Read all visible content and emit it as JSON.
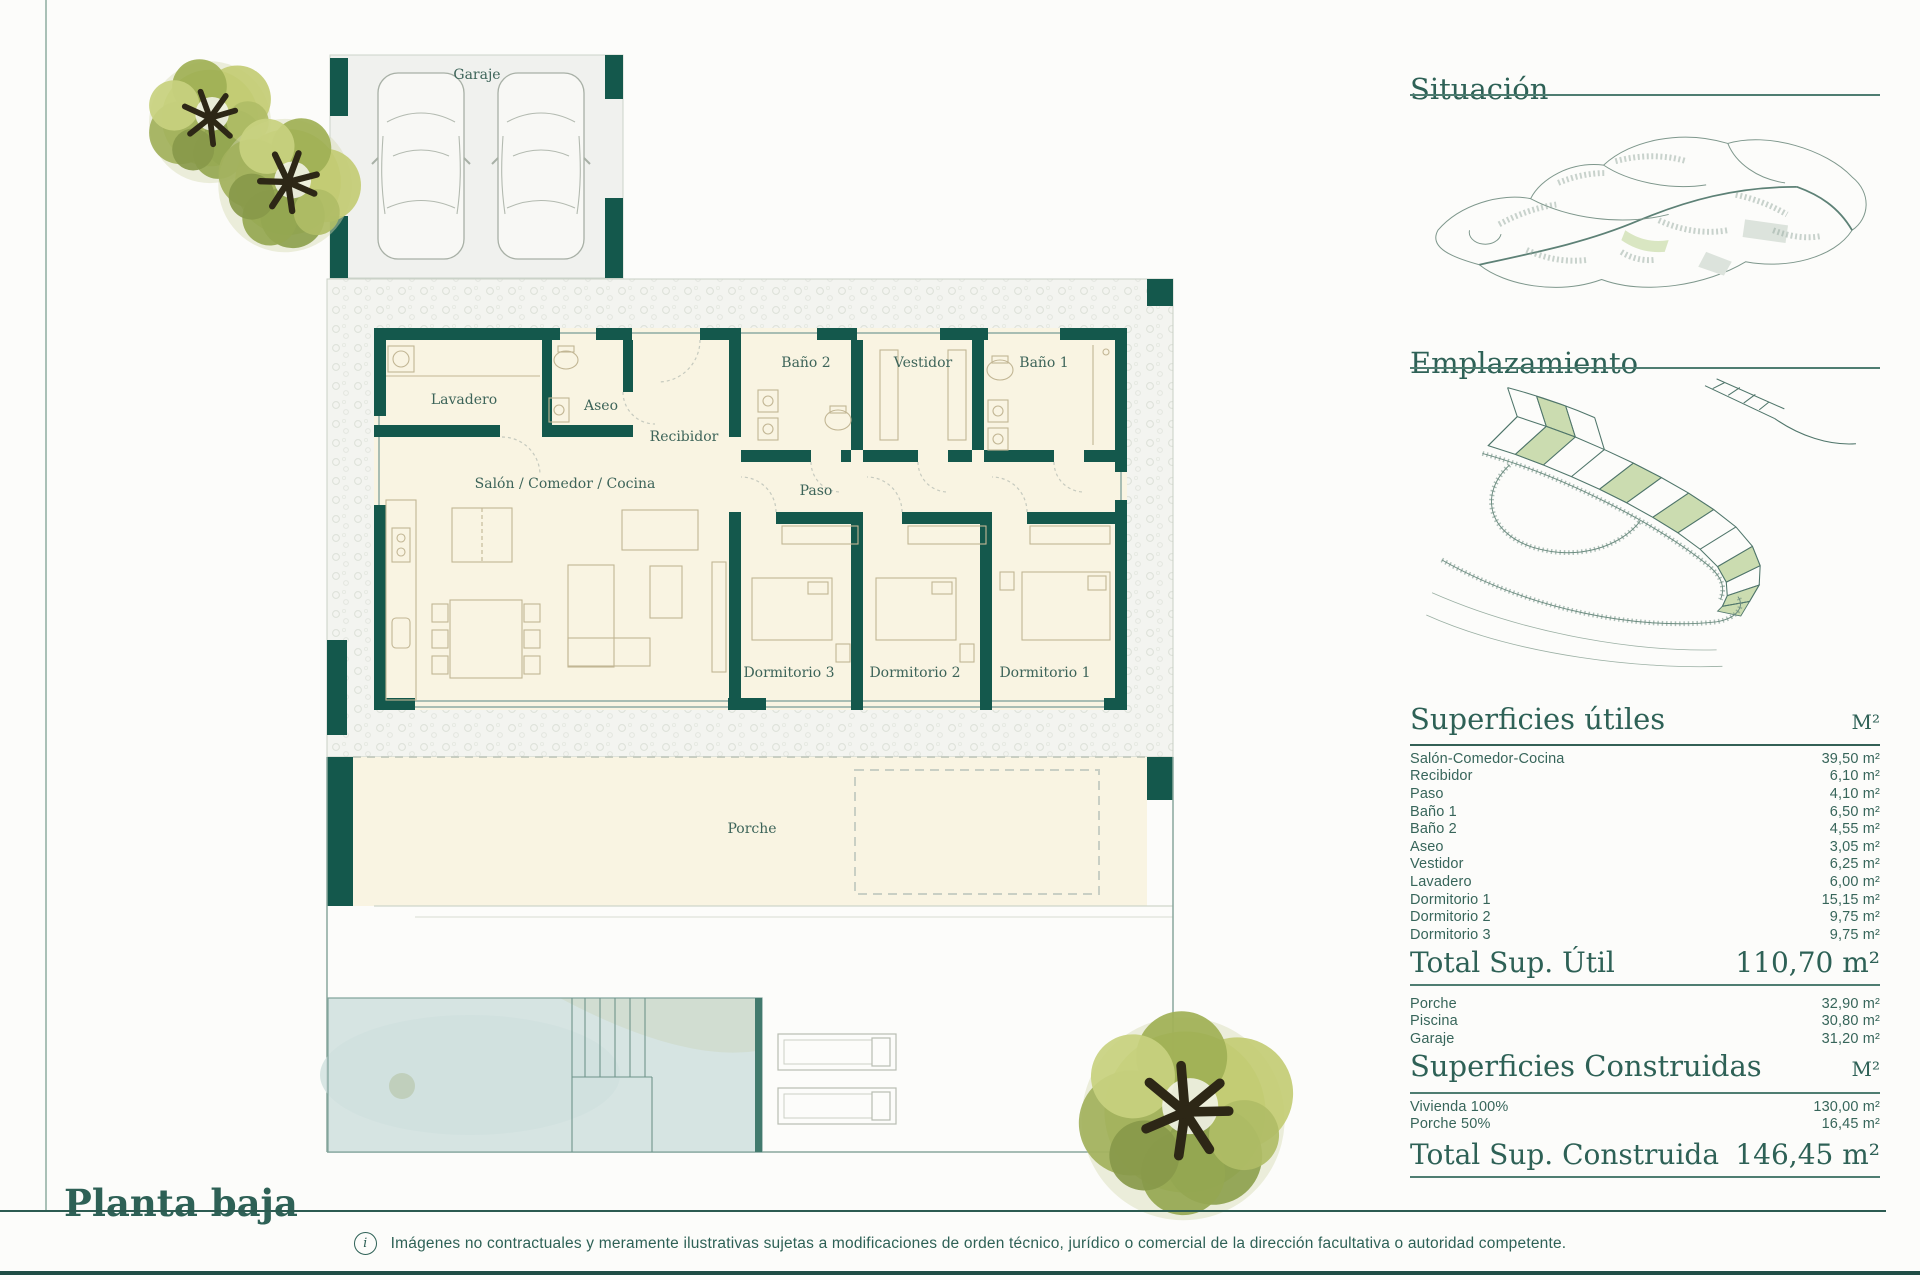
{
  "page": {
    "title": "Planta baja",
    "info_icon": "i",
    "disclaimer": "Imágenes no contractuales y meramente ilustrativas sujetas a modificaciones de orden técnico, jurídico o comercial de la dirección facultativa o autoridad competente."
  },
  "floorplan": {
    "rooms": {
      "garaje": "Garaje",
      "lavadero": "Lavadero",
      "aseo": "Aseo",
      "recibidor": "Recibidor",
      "bano_2": "Baño 2",
      "vestidor": "Vestidor",
      "bano_1": "Baño 1",
      "salon": "Salón / Comedor / Cocina",
      "paso": "Paso",
      "dormitorio_3": "Dormitorio 3",
      "dormitorio_2": "Dormitorio 2",
      "dormitorio_1": "Dormitorio 1",
      "porche": "Porche"
    }
  },
  "sidebar": {
    "situacion_title": "Situación",
    "emplazamiento_title": "Emplazamiento",
    "superficies_utiles": {
      "title": "Superficies útiles",
      "unit": "M²",
      "rows": [
        {
          "label": "Salón-Comedor-Cocina",
          "value": "39,50 m²"
        },
        {
          "label": "Recibidor",
          "value": "6,10 m²"
        },
        {
          "label": "Paso",
          "value": "4,10 m²"
        },
        {
          "label": "Baño 1",
          "value": "6,50 m²"
        },
        {
          "label": "Baño 2",
          "value": "4,55 m²"
        },
        {
          "label": "Aseo",
          "value": "3,05 m²"
        },
        {
          "label": "Vestidor",
          "value": "6,25 m²"
        },
        {
          "label": "Lavadero",
          "value": "6,00 m²"
        },
        {
          "label": "Dormitorio 1",
          "value": "15,15 m²"
        },
        {
          "label": "Dormitorio 2",
          "value": "9,75 m²"
        },
        {
          "label": "Dormitorio 3",
          "value": "9,75 m²"
        }
      ],
      "total_label": "Total Sup. Útil",
      "total_value": "110,70 m²"
    },
    "extras": [
      {
        "label": "Porche",
        "value": "32,90 m²"
      },
      {
        "label": "Piscina",
        "value": "30,80 m²"
      },
      {
        "label": "Garaje",
        "value": "31,20 m²"
      }
    ],
    "superficies_construidas": {
      "title": "Superficies Construidas",
      "unit": "M²",
      "rows": [
        {
          "label": "Vivienda 100%",
          "value": "130,00 m²"
        },
        {
          "label": "Porche 50%",
          "value": "16,45 m²"
        }
      ],
      "total_label": "Total Sup. Construida",
      "total_value": "146,45 m²"
    }
  }
}
